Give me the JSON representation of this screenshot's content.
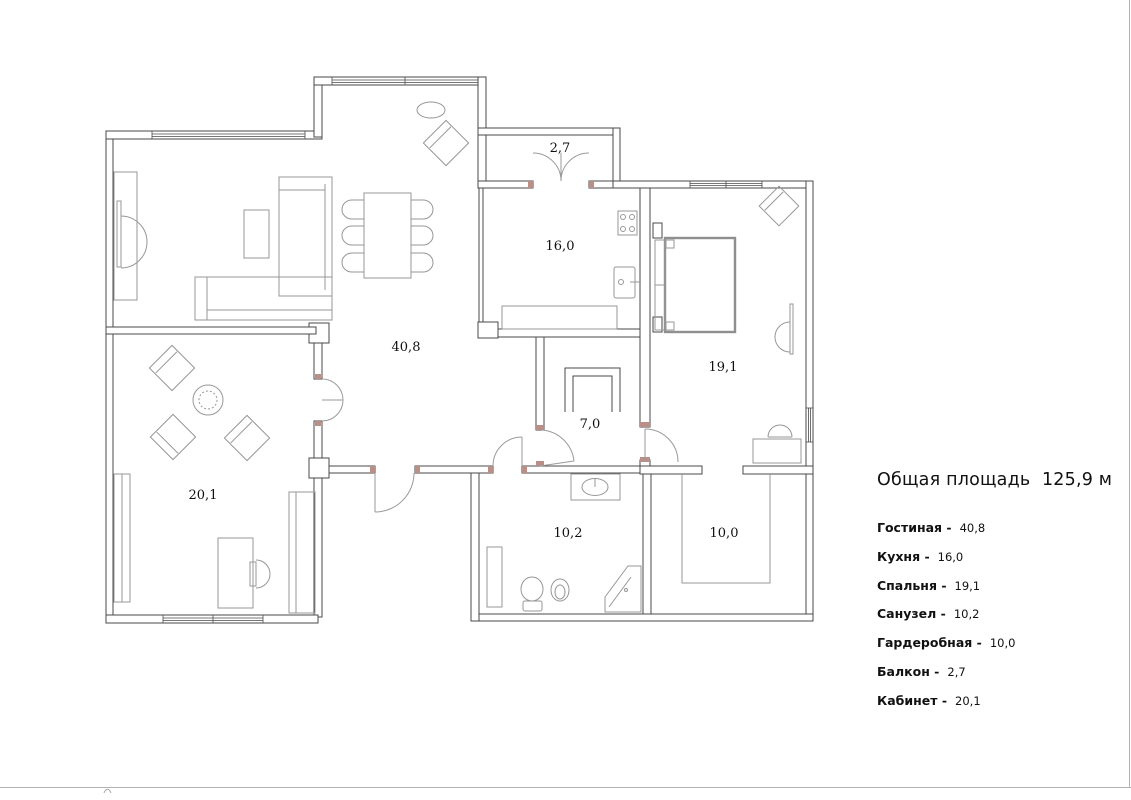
{
  "legend": {
    "title": "Общая площадь  125,9 м",
    "items": [
      {
        "label": "Гостиная -",
        "value": "40,8"
      },
      {
        "label": "Кухня -",
        "value": "16,0"
      },
      {
        "label": "Спальня -",
        "value": "19,1"
      },
      {
        "label": "Санузел -",
        "value": "10,2"
      },
      {
        "label": "Гардеробная -",
        "value": "10,0"
      },
      {
        "label": "Балкон -",
        "value": "2,7"
      },
      {
        "label": "Кабинет -",
        "value": "20,1"
      }
    ]
  },
  "rooms": {
    "living": {
      "area": "40,8"
    },
    "kitchen": {
      "area": "16,0"
    },
    "balcony": {
      "area": "2,7"
    },
    "bedroom": {
      "area": "19,1"
    },
    "hallway": {
      "area": "7,0"
    },
    "office": {
      "area": "20,1"
    },
    "bathroom": {
      "area": "10,2"
    },
    "wardrobe": {
      "area": "10,0"
    }
  },
  "colors": {
    "wall": "#4a4a4a",
    "furniture": "#979797",
    "door_arc": "#9a9a9a",
    "door_jamb": "#b98f88",
    "page_border": "#b3b3b3",
    "text": "#111111"
  }
}
